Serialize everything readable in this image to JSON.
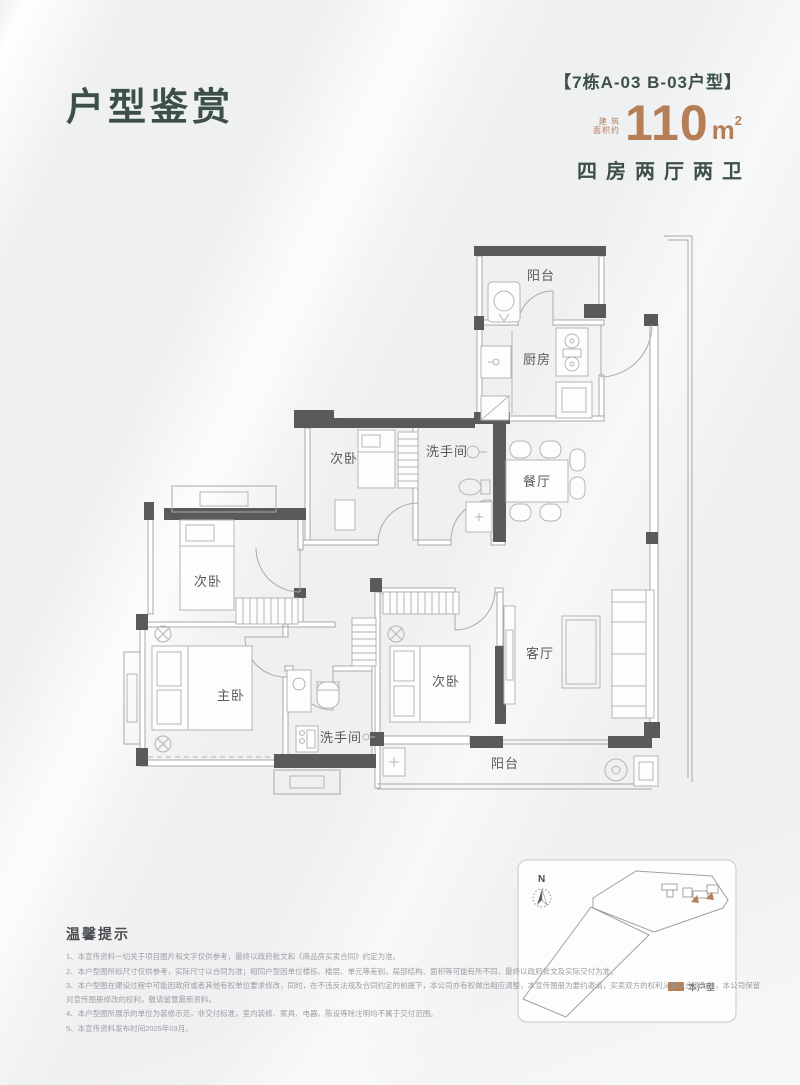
{
  "page": {
    "title": "户型鉴赏"
  },
  "header": {
    "unit_tag": "【7栋A-03  B-03户型】",
    "area_prefix_line1": "建 筑",
    "area_prefix_line2": "面积约",
    "area_value": "110",
    "area_unit": "m",
    "area_sup": "2",
    "layout_desc": "四房两厅两卫"
  },
  "colors": {
    "accent_green": "#3c4f48",
    "accent_copper": "#b57e57",
    "wall_dark": "#595a5c"
  },
  "floorplan": {
    "rooms": [
      {
        "id": "balcony-top",
        "label": "阳台"
      },
      {
        "id": "kitchen",
        "label": "厨房"
      },
      {
        "id": "bedroom-top",
        "label": "次卧"
      },
      {
        "id": "bathroom-top",
        "label": "洗手间"
      },
      {
        "id": "dining",
        "label": "餐厅"
      },
      {
        "id": "bedroom-left",
        "label": "次卧"
      },
      {
        "id": "master-bedroom",
        "label": "主卧"
      },
      {
        "id": "bathroom-bottom",
        "label": "洗手间"
      },
      {
        "id": "bedroom-mid",
        "label": "次卧"
      },
      {
        "id": "living",
        "label": "客厅"
      },
      {
        "id": "balcony-bottom",
        "label": "阳台"
      }
    ]
  },
  "sitemap": {
    "north_label": "N",
    "legend_label": "本户型"
  },
  "tips": {
    "heading": "温馨提示",
    "items": [
      "1、本宣传资料一切关于项目图片和文字仅供参考，最终以政府批文和《商品房买卖合同》约定为准。",
      "2、本户型图所标尺寸仅供参考，实际尺寸以合同为准；相同户型因单位楼栋、楼层、单元等差别，局部结构、面积等可能有所不同，最终以政府批文及实际交付为准。",
      "3、本户型图在建设过程中可能因政府或者其他有权单位要求修改，同时，在不违反法规及合同约定的前提下，本公司亦有权做出相应调整，本宣传图册为要约邀请，买卖双方的权利义务以合同为准，本公司保留对宣传图册修改的权利，敬请留意最新资料。",
      "4、本户型图所展示的单位为装修示范，非交付标准，室内装修、家具、电器、陈设等除注明均不属于交付范围。",
      "5、本宣传资料发布时间2025年03月。"
    ]
  }
}
